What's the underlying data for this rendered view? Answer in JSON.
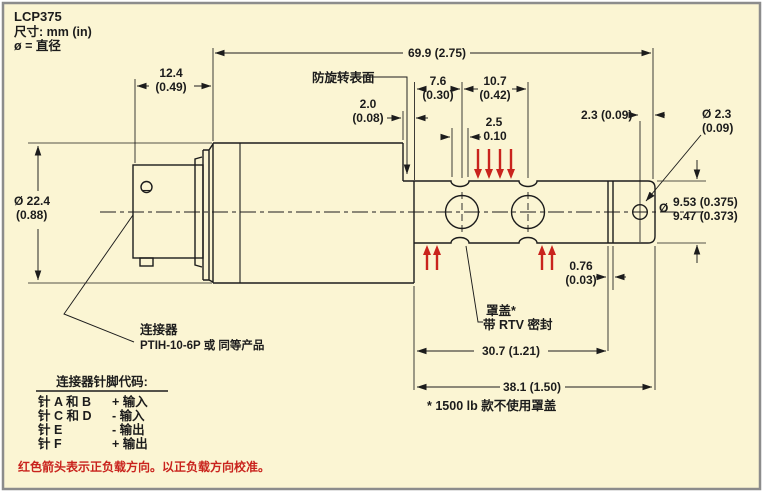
{
  "title": {
    "model": "LCP375",
    "units_note": "尺寸:  mm (in)",
    "dia_note": "ø = 直径"
  },
  "labels": {
    "anti_rotation": "防旋转表面",
    "cover_line1": "罩盖*",
    "cover_line2": "带 RTV 密封",
    "cover_footnote": "* 1500 lb 款不使用罩盖",
    "connector_line1": "连接器",
    "connector_line2": "PTIH-10-6P 或 同等产品"
  },
  "dims": {
    "overall": "69.9 (2.75)",
    "front_mm": "12.4",
    "front_in": "(0.49)",
    "body_dia_mm": "Ø 22.4",
    "body_dia_in": "(0.88)",
    "step_mm": "2.0",
    "step_in": "(0.08)",
    "d76_mm": "7.6",
    "d76_in": "(0.30)",
    "d107_mm": "10.7",
    "d107_in": "(0.42)",
    "groove_mm": "2.5",
    "groove_in": "0.10",
    "offset23": "2.3 (0.09)",
    "hole_mm": "Ø 2.3",
    "hole_in": "(0.09)",
    "shaft_dia_sym": "Ø",
    "shaft_dia_upper": "9.53 (0.375)",
    "shaft_dia_lower": "9.47 (0.373)",
    "band_mm": "0.76",
    "band_in": "(0.03)",
    "cover_len": "30.7 (1.21)",
    "total_len": "38.1 (1.50)"
  },
  "pin_table": {
    "title": "连接器针脚代码:",
    "rows": [
      {
        "pin": "针 A 和 B",
        "signal": "+ 输入"
      },
      {
        "pin": "针 C 和 D",
        "signal": "- 输入"
      },
      {
        "pin": "针 E",
        "signal": "- 输出"
      },
      {
        "pin": "针 F",
        "signal": "+ 输出"
      }
    ]
  },
  "note_red": "红色箭头表示正负载方向。以正负载方向校准。",
  "colors": {
    "background": "#FBF5D3",
    "line": "#1c1c1c",
    "red": "#c9231d",
    "border": "#8c8c8c"
  }
}
